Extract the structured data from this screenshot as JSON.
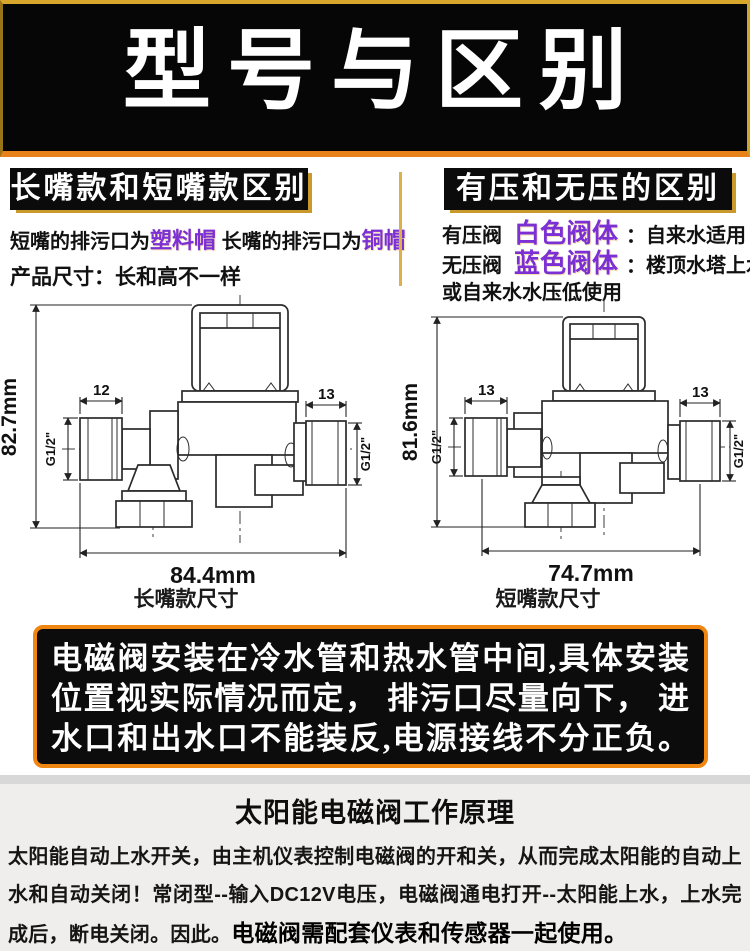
{
  "colors": {
    "banner_bg": "#060606",
    "border_gold": "#d9a62c",
    "border_orange": "#e8821a",
    "highlight_purple": "#7b2fd4",
    "divider_gold": "#ddb14a",
    "notice_border": "#ee8611",
    "principle_bg": "#efeeec"
  },
  "banner": {
    "title": "型号与区别"
  },
  "left_section": {
    "header": "长嘴款和短嘴款区别",
    "line1": [
      "短嘴的排污口为",
      "塑料帽",
      " 长嘴的排污口为",
      "铜帽"
    ],
    "line2": "产品尺寸：长和高不一样"
  },
  "right_section": {
    "header": "有压和无压的区别",
    "rows": [
      {
        "name": "有压阀",
        "type": "白色阀体",
        "colon": "：",
        "use": "自来水适用"
      },
      {
        "name": "无压阀",
        "type": "蓝色阀体",
        "colon": "：",
        "use": "楼顶水塔上水"
      }
    ],
    "line3": "或自来水水压低使用"
  },
  "diagrams": {
    "left": {
      "height": "82.7mm",
      "width": "84.4mm",
      "dim_left": "12",
      "dim_right": "13",
      "thread_left": "G1/2\"",
      "thread_right": "G1/2\"",
      "caption": "长嘴款尺寸"
    },
    "right": {
      "height": "81.6mm",
      "width": "74.7mm",
      "dim_left": "13",
      "dim_right": "13",
      "thread_left": "G1/2\"",
      "thread_right": "G1/2\"",
      "caption": "短嘴款尺寸"
    }
  },
  "notice": {
    "lines": [
      "电磁阀安装在冷水管和热水管中间,具体安装",
      "位置视实际情况而定， 排污口尽量向下， 进",
      "水口和出水口不能装反,电源接线不分正负。"
    ]
  },
  "principle": {
    "heading": "太阳能电磁阀工作原理",
    "body_normal": "太阳能自动上水开关，由主机仪表控制电磁阀的开和关，从而完成太阳能的自动上水和自动关闭！常闭型--输入DC12V电压，电磁阀通电打开--太阳能上水，上水完成后，断电关闭。因此。",
    "body_bold": "电磁阀需配套仪表和传感器一起使用。"
  }
}
